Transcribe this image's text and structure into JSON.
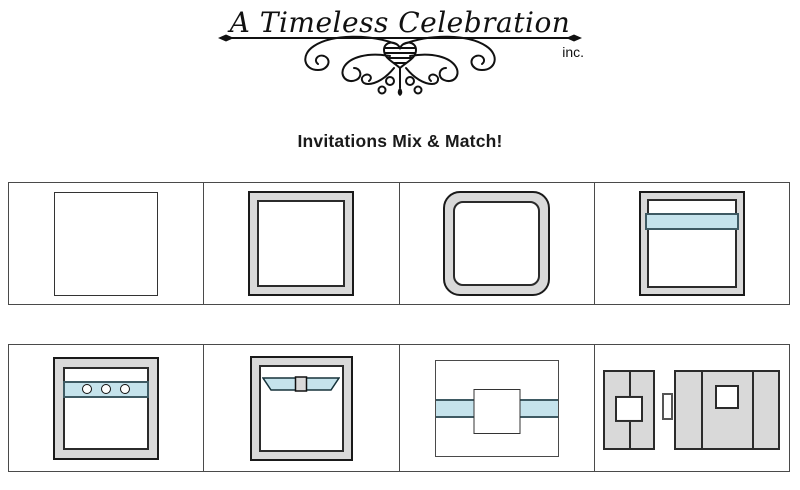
{
  "logo": {
    "brand": "A Timeless Celebration",
    "suffix": "inc."
  },
  "heading": {
    "title": "Invitations Mix & Match!"
  },
  "colors": {
    "frame_gray": "#d9d9d9",
    "band_blue": "#c5e3ec",
    "band_border": "#3e5a63",
    "outline": "#1a1a1a",
    "grid_border": "#4a4a4a"
  },
  "gallery": {
    "rows": [
      {
        "items": [
          {
            "name": "plain-square-card"
          },
          {
            "name": "square-frame-card"
          },
          {
            "name": "rounded-frame-card"
          },
          {
            "name": "frame-with-ribbon-band"
          }
        ]
      },
      {
        "items": [
          {
            "name": "frame-with-button-band"
          },
          {
            "name": "frame-with-bow"
          },
          {
            "name": "belly-band-invitation"
          },
          {
            "name": "gatefold-invitation"
          }
        ]
      }
    ]
  }
}
